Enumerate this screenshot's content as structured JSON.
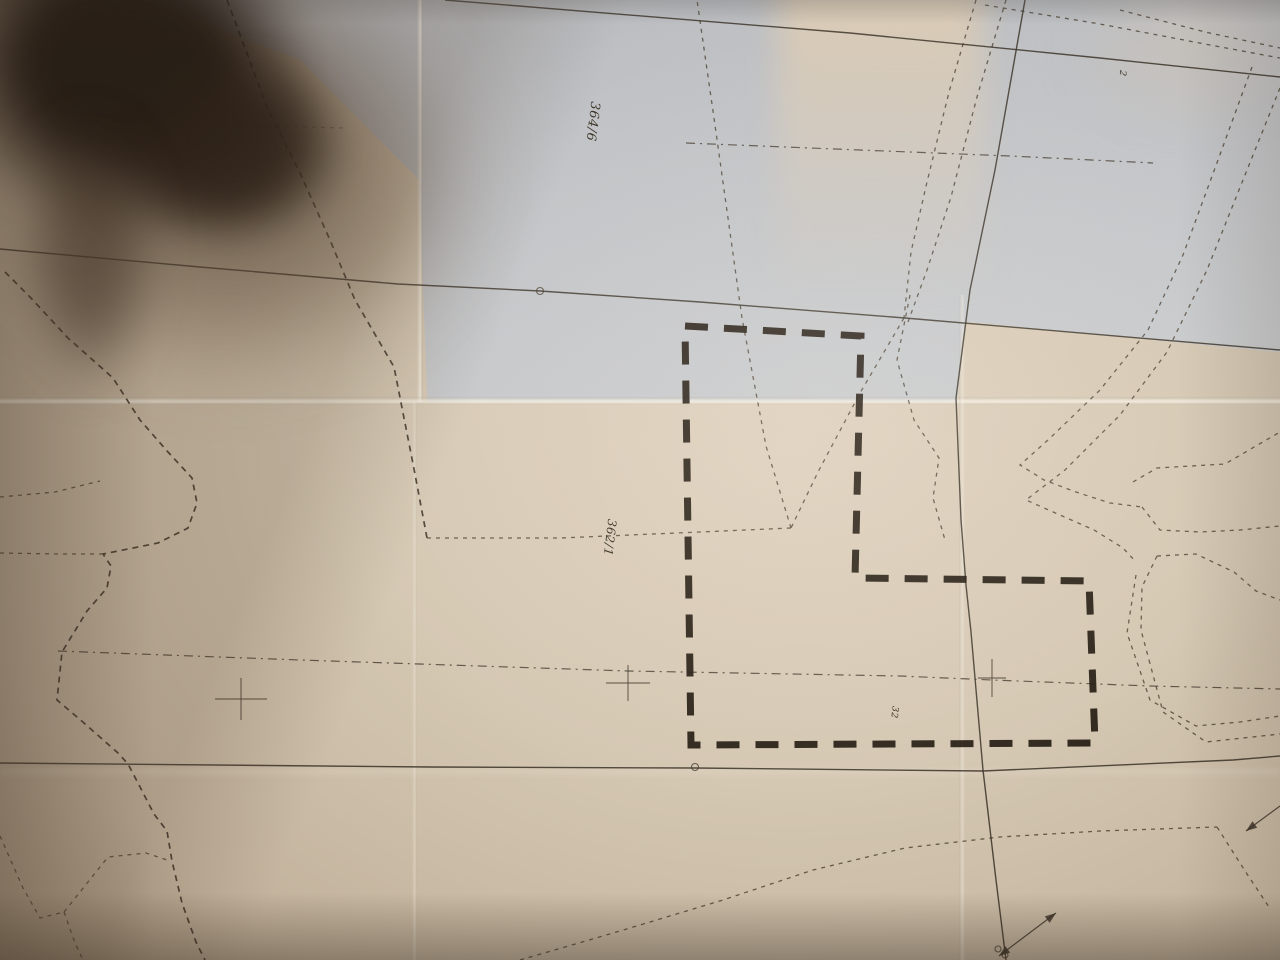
{
  "colors": {
    "paper_warm": "#d4c7b2",
    "paper_edge": "#a3927b",
    "paper_grey": "#c6c9cd",
    "ink_heavy": "#241b11",
    "ink_line": "#3c352c",
    "shadow_core": "#251b13"
  },
  "map": {
    "highlight_parcel": {
      "points": [
        [
          685,
          326
        ],
        [
          861,
          336
        ],
        [
          855,
          578
        ],
        [
          1089,
          581
        ],
        [
          1095,
          743
        ],
        [
          691,
          745
        ]
      ]
    },
    "solid_lines": [
      {
        "name": "boundary-line-top",
        "points": [
          [
            445,
            0
          ],
          [
            850,
            33
          ],
          [
            1100,
            58
          ],
          [
            1280,
            77
          ]
        ]
      },
      {
        "name": "boundary-line-middle",
        "points": [
          [
            0,
            249
          ],
          [
            200,
            267
          ],
          [
            398,
            284
          ],
          [
            540,
            291
          ],
          [
            700,
            302
          ],
          [
            905,
            318
          ],
          [
            1280,
            350
          ]
        ]
      },
      {
        "name": "boundary-line-vertical",
        "points": [
          [
            1025,
            0
          ],
          [
            995,
            170
          ],
          [
            970,
            290
          ],
          [
            956,
            398
          ],
          [
            961,
            520
          ],
          [
            966,
            585
          ],
          [
            971,
            632
          ],
          [
            983,
            770
          ],
          [
            996,
            880
          ],
          [
            1006,
            960
          ]
        ]
      },
      {
        "name": "boundary-line-bottom",
        "points": [
          [
            0,
            763
          ],
          [
            430,
            767
          ],
          [
            695,
            768
          ],
          [
            983,
            771
          ],
          [
            1233,
            760
          ],
          [
            1280,
            756
          ]
        ]
      }
    ],
    "dashdot_lines": [
      {
        "name": "survey-axis-main",
        "points": [
          [
            58,
            651
          ],
          [
            300,
            660
          ],
          [
            628,
            671
          ],
          [
            900,
            676
          ],
          [
            992,
            680
          ],
          [
            1150,
            686
          ],
          [
            1280,
            689
          ]
        ]
      },
      {
        "name": "survey-axis-northeast",
        "points": [
          [
            686,
            143
          ],
          [
            860,
            150
          ],
          [
            1010,
            156
          ],
          [
            1153,
            163
          ]
        ]
      }
    ],
    "dotted_lines": [
      {
        "name": "west-meander",
        "heavy": true,
        "points": [
          [
            5,
            272
          ],
          [
            30,
            297
          ],
          [
            68,
            338
          ],
          [
            113,
            378
          ],
          [
            140,
            420
          ],
          [
            168,
            452
          ],
          [
            192,
            478
          ],
          [
            197,
            503
          ],
          [
            188,
            528
          ],
          [
            158,
            543
          ],
          [
            118,
            551
          ],
          [
            103,
            554
          ],
          [
            111,
            566
          ],
          [
            107,
            588
          ],
          [
            87,
            611
          ],
          [
            62,
            652
          ],
          [
            57,
            700
          ],
          [
            84,
            723
          ],
          [
            118,
            753
          ],
          [
            128,
            764
          ],
          [
            139,
            785
          ],
          [
            154,
            814
          ],
          [
            167,
            831
          ],
          [
            172,
            861
          ],
          [
            182,
            903
          ],
          [
            196,
            942
          ],
          [
            205,
            960
          ]
        ]
      },
      {
        "name": "west-spur-upper",
        "points": [
          [
            0,
            497
          ],
          [
            55,
            492
          ],
          [
            100,
            481
          ]
        ]
      },
      {
        "name": "west-spur-lower",
        "points": [
          [
            0,
            553
          ],
          [
            60,
            554
          ],
          [
            102,
            554
          ]
        ]
      },
      {
        "name": "southwest-branch-a",
        "points": [
          [
            0,
            836
          ],
          [
            23,
            888
          ],
          [
            40,
            918
          ],
          [
            64,
            912
          ]
        ]
      },
      {
        "name": "southwest-branch-b",
        "points": [
          [
            64,
            912
          ],
          [
            108,
            857
          ],
          [
            146,
            853
          ],
          [
            170,
            861
          ]
        ]
      },
      {
        "name": "southwest-branch-c",
        "points": [
          [
            64,
            912
          ],
          [
            75,
            943
          ],
          [
            83,
            960
          ]
        ]
      },
      {
        "name": "northwest-diagonal",
        "heavy": true,
        "points": [
          [
            227,
            0
          ],
          [
            267,
            107
          ],
          [
            300,
            173
          ],
          [
            330,
            240
          ],
          [
            355,
            300
          ],
          [
            394,
            367
          ],
          [
            414,
            469
          ],
          [
            427,
            538
          ]
        ]
      },
      {
        "name": "parcel-362-south-edge",
        "points": [
          [
            427,
            538
          ],
          [
            560,
            538
          ],
          [
            700,
            532
          ],
          [
            791,
            528
          ]
        ]
      },
      {
        "name": "parcel-362-east-edge",
        "points": [
          [
            791,
            528
          ],
          [
            766,
            446
          ],
          [
            742,
            318
          ],
          [
            714,
            118
          ],
          [
            697,
            0
          ]
        ]
      },
      {
        "name": "junction-spur",
        "points": [
          [
            904,
            318
          ],
          [
            860,
            393
          ],
          [
            818,
            472
          ],
          [
            791,
            528
          ]
        ]
      },
      {
        "name": "road-edge-west",
        "points": [
          [
            976,
            0
          ],
          [
            949,
            92
          ],
          [
            927,
            182
          ],
          [
            911,
            252
          ],
          [
            904,
            318
          ]
        ]
      },
      {
        "name": "road-edge-east",
        "points": [
          [
            1006,
            0
          ],
          [
            977,
            97
          ],
          [
            951,
            197
          ],
          [
            927,
            270
          ],
          [
            908,
            322
          ]
        ]
      },
      {
        "name": "northeast-boundary-a",
        "points": [
          [
            985,
            5
          ],
          [
            1100,
            24
          ],
          [
            1210,
            45
          ],
          [
            1280,
            58
          ]
        ]
      },
      {
        "name": "northeast-boundary-b",
        "points": [
          [
            1120,
            10
          ],
          [
            1205,
            32
          ],
          [
            1280,
            48
          ]
        ]
      },
      {
        "name": "east-channel-outer",
        "points": [
          [
            1252,
            67
          ],
          [
            1218,
            160
          ],
          [
            1183,
            255
          ],
          [
            1148,
            330
          ],
          [
            1100,
            390
          ],
          [
            1048,
            440
          ],
          [
            1020,
            465
          ],
          [
            1044,
            480
          ],
          [
            1076,
            492
          ],
          [
            1110,
            503
          ],
          [
            1142,
            507
          ]
        ]
      },
      {
        "name": "east-channel-inner",
        "points": [
          [
            1280,
            88
          ],
          [
            1243,
            180
          ],
          [
            1207,
            270
          ],
          [
            1167,
            352
          ],
          [
            1120,
            415
          ],
          [
            1065,
            470
          ],
          [
            1026,
            500
          ],
          [
            1060,
            515
          ],
          [
            1094,
            530
          ],
          [
            1123,
            548
          ],
          [
            1136,
            562
          ]
        ]
      },
      {
        "name": "east-strip-top",
        "points": [
          [
            1133,
            482
          ],
          [
            1157,
            468
          ],
          [
            1225,
            464
          ],
          [
            1280,
            432
          ]
        ]
      },
      {
        "name": "east-strip-bottom",
        "points": [
          [
            1142,
            507
          ],
          [
            1160,
            530
          ],
          [
            1200,
            532
          ],
          [
            1240,
            530
          ],
          [
            1280,
            526
          ]
        ]
      },
      {
        "name": "east-pocket-top",
        "points": [
          [
            1157,
            556
          ],
          [
            1196,
            554
          ],
          [
            1234,
            572
          ],
          [
            1256,
            591
          ],
          [
            1280,
            600
          ]
        ]
      },
      {
        "name": "east-pocket-west",
        "points": [
          [
            1157,
            556
          ],
          [
            1142,
            587
          ],
          [
            1141,
            630
          ],
          [
            1149,
            660
          ]
        ]
      },
      {
        "name": "east-channel-south",
        "points": [
          [
            1136,
            575
          ],
          [
            1127,
            633
          ],
          [
            1150,
            700
          ],
          [
            1196,
            726
          ],
          [
            1240,
            722
          ],
          [
            1280,
            716
          ]
        ]
      },
      {
        "name": "east-channel-south-b",
        "points": [
          [
            1149,
            660
          ],
          [
            1163,
            712
          ],
          [
            1206,
            742
          ],
          [
            1280,
            734
          ]
        ]
      },
      {
        "name": "southeast-diagonal",
        "points": [
          [
            520,
            960
          ],
          [
            620,
            931
          ],
          [
            723,
            900
          ],
          [
            813,
            870
          ],
          [
            905,
            848
          ],
          [
            1000,
            837
          ],
          [
            1100,
            831
          ],
          [
            1217,
            827
          ]
        ]
      },
      {
        "name": "southeast-branch",
        "points": [
          [
            1217,
            827
          ],
          [
            1247,
            874
          ],
          [
            1269,
            907
          ]
        ]
      },
      {
        "name": "polygon-east-wavy",
        "points": [
          [
            910,
            295
          ],
          [
            897,
            360
          ],
          [
            914,
            420
          ],
          [
            939,
            458
          ],
          [
            933,
            498
          ],
          [
            945,
            540
          ]
        ]
      },
      {
        "name": "shadowed-faint-line",
        "faint": true,
        "points": [
          [
            78,
            120
          ],
          [
            200,
            124
          ],
          [
            345,
            128
          ]
        ]
      }
    ],
    "crosses": [
      {
        "name": "survey-cross-west",
        "x": 241,
        "y": 699,
        "w": 52,
        "h": 42
      },
      {
        "name": "survey-cross-center",
        "x": 628,
        "y": 683,
        "w": 44,
        "h": 36
      },
      {
        "name": "survey-cross-east",
        "x": 992,
        "y": 678,
        "w": 28,
        "h": 38
      }
    ],
    "circles": [
      {
        "name": "boundary-point-a",
        "x": 540,
        "y": 291,
        "r": 3.5
      },
      {
        "name": "boundary-point-b",
        "x": 695,
        "y": 767,
        "r": 3.5
      },
      {
        "name": "benchmark-point-a",
        "x": 998,
        "y": 949,
        "r": 3
      },
      {
        "name": "benchmark-point-b",
        "x": 1005,
        "y": 955,
        "r": 3
      }
    ],
    "arrows": [
      {
        "name": "benchmark-arrow",
        "from": [
          999,
          956
        ],
        "to": [
          1056,
          913
        ],
        "heads": "both"
      },
      {
        "name": "east-edge-arrow",
        "from": [
          1280,
          806
        ],
        "to": [
          1246,
          831
        ],
        "heads": "end"
      }
    ],
    "labels": [
      {
        "name": "parcel-label-364-6",
        "text": "364/6",
        "x": 589,
        "y": 121,
        "rotation": 97,
        "size": 13
      },
      {
        "name": "parcel-label-362-1",
        "text": "362/1",
        "x": 606,
        "y": 537,
        "rotation": 97,
        "size": 12
      },
      {
        "name": "small-label-2",
        "text": "2",
        "x": 1120,
        "y": 73,
        "rotation": 97,
        "size": 9
      },
      {
        "name": "small-label-32",
        "text": "32",
        "x": 892,
        "y": 712,
        "rotation": 97,
        "size": 9
      }
    ]
  }
}
